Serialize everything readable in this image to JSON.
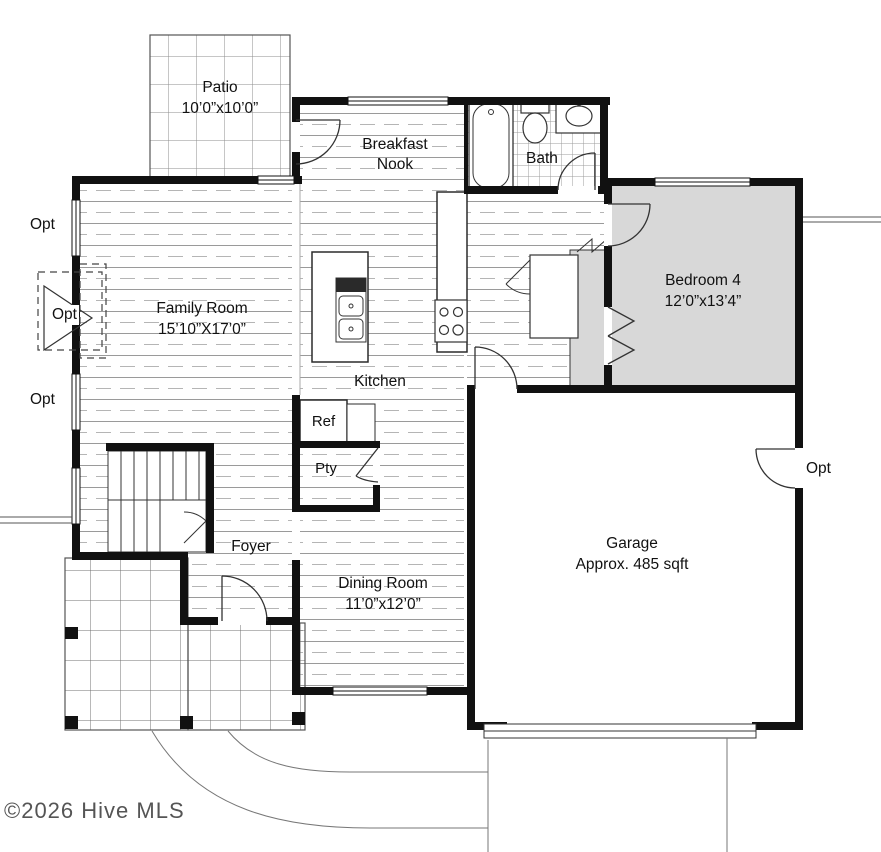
{
  "watermark": "©2026 Hive MLS",
  "rooms": {
    "patio": {
      "name": "Patio",
      "dims": "10’0”x10’0”"
    },
    "breakfast_nook": {
      "name": "Breakfast Nook"
    },
    "bath": {
      "name": "Bath"
    },
    "bedroom_4": {
      "name": "Bedroom 4",
      "dims": "12’0”x13’4”"
    },
    "family_room": {
      "name": "Family Room",
      "dims": "15’10”X17’0”"
    },
    "kitchen": {
      "name": "Kitchen"
    },
    "foyer": {
      "name": "Foyer"
    },
    "dining_room": {
      "name": "Dining Room",
      "dims": "11’0”x12’0”"
    },
    "garage": {
      "name": "Garage",
      "dims": "Approx. 485 sqft"
    }
  },
  "fixtures": {
    "refrigerator": "Ref",
    "pantry": "Pty"
  },
  "options": {
    "left_window_top": "Opt",
    "fireplace": "Opt",
    "left_window_bottom": "Opt",
    "garage_side_door": "Opt"
  },
  "colors": {
    "wall": "#111111",
    "bedroom_fill": "#d8d8d8",
    "floor_line": "#9a9a9a",
    "watermark": "#555555"
  }
}
